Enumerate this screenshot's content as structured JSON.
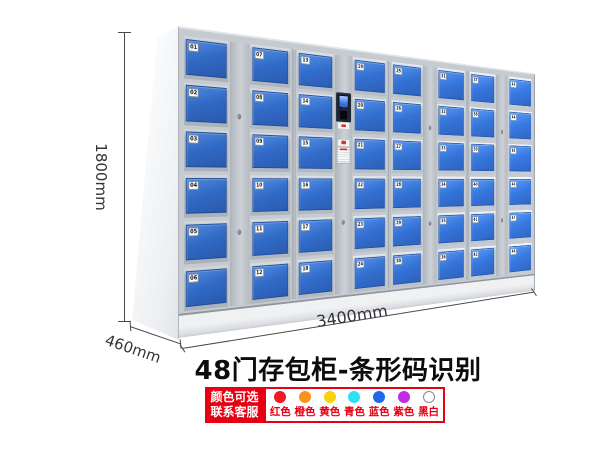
{
  "product": {
    "title": "48门存包柜-条形码识别",
    "dimensions": {
      "height": "1800mm",
      "depth": "460mm",
      "width": "3400mm"
    },
    "locker": {
      "door_count": 48,
      "body_color": "#c6cbd1",
      "door_color": "#2e66c0",
      "segments": [
        {
          "type": "doors",
          "numbers": [
            "01",
            "02",
            "03",
            "04",
            "05",
            "06"
          ]
        },
        {
          "type": "strip",
          "locks": [
            27,
            71
          ]
        },
        {
          "type": "doors",
          "numbers": [
            "07",
            "08",
            "09",
            "10",
            "11",
            "12"
          ]
        },
        {
          "type": "divider"
        },
        {
          "type": "doors",
          "numbers": [
            "13",
            "14",
            "15",
            "16",
            "17",
            "18"
          ]
        },
        {
          "type": "control",
          "locks": [
            69
          ]
        },
        {
          "type": "doors",
          "numbers": [
            "19",
            "20",
            "21",
            "22",
            "23",
            "24"
          ]
        },
        {
          "type": "divider"
        },
        {
          "type": "doors",
          "numbers": [
            "25",
            "26",
            "27",
            "28",
            "29",
            "30"
          ]
        },
        {
          "type": "strip",
          "locks": [
            27,
            71
          ]
        },
        {
          "type": "doors",
          "numbers": [
            "31",
            "32",
            "33",
            "34",
            "35",
            "36"
          ]
        },
        {
          "type": "divider"
        },
        {
          "type": "doors",
          "numbers": [
            "37",
            "38",
            "39",
            "40",
            "41",
            "42"
          ]
        },
        {
          "type": "strip",
          "locks": [
            27,
            71
          ]
        },
        {
          "type": "doors",
          "numbers": [
            "43",
            "44",
            "45",
            "46",
            "47",
            "48"
          ]
        }
      ]
    },
    "legend": {
      "badge": {
        "line1": "颜色可选",
        "line2": "联系客服",
        "background": "#e60012",
        "text_color": "#ffffff"
      },
      "label_color": "#e60012",
      "options": [
        {
          "label": "红色",
          "color": "#ed1c24"
        },
        {
          "label": "橙色",
          "color": "#f7941d"
        },
        {
          "label": "黄色",
          "color": "#f6d30b"
        },
        {
          "label": "青色",
          "color": "#31dff5"
        },
        {
          "label": "蓝色",
          "color": "#1c6ae8"
        },
        {
          "label": "紫色",
          "color": "#c32ce6"
        },
        {
          "label": "黑白",
          "color": "#ffffff",
          "outlined": true
        }
      ]
    }
  }
}
